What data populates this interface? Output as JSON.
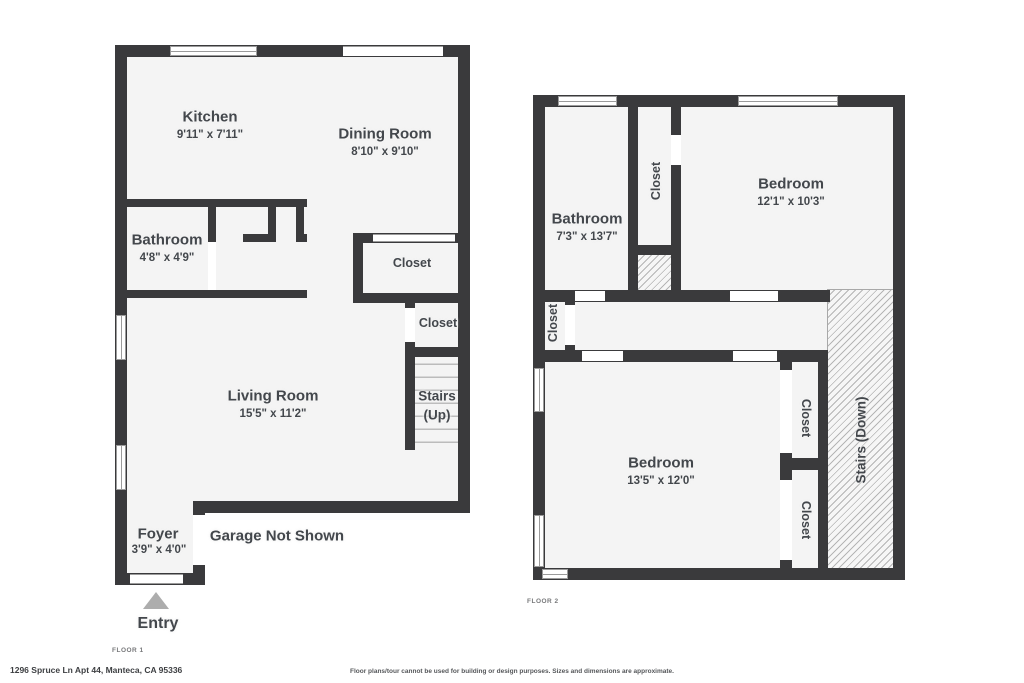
{
  "floor1": {
    "floor_label": "FLOOR 1",
    "kitchen": {
      "name": "Kitchen",
      "dims": "9'11\" x 7'11\""
    },
    "dining_room": {
      "name": "Dining Room",
      "dims": "8'10\" x 9'10\""
    },
    "bathroom": {
      "name": "Bathroom",
      "dims": "4'8\" x 4'9\""
    },
    "closet_upper": {
      "name": "Closet"
    },
    "closet_lower": {
      "name": "Closet"
    },
    "living_room": {
      "name": "Living Room",
      "dims": "15'5\" x 11'2\""
    },
    "stairs": {
      "name": "Stairs",
      "direction": "(Up)"
    },
    "foyer": {
      "name": "Foyer",
      "dims": "3'9\" x 4'0\""
    },
    "garage_note": "Garage Not Shown",
    "entry_label": "Entry"
  },
  "floor2": {
    "floor_label": "FLOOR 2",
    "bathroom": {
      "name": "Bathroom",
      "dims": "7'3\" x 13'7\""
    },
    "closet_bedroom_top": {
      "name": "Closet"
    },
    "bedroom_top": {
      "name": "Bedroom",
      "dims": "12'1\" x 10'3\""
    },
    "closet_hall": {
      "name": "Closet"
    },
    "bedroom_main": {
      "name": "Bedroom",
      "dims": "13'5\" x 12'0\""
    },
    "closet_right_upper": {
      "name": "Closet"
    },
    "closet_right_lower": {
      "name": "Closet"
    },
    "stairs_label": "Stairs (Down)"
  },
  "footer": {
    "address": "1296 Spruce Ln Apt 44, Manteca, CA 95336",
    "disclaimer": "Floor plans/tour cannot be used for building or design purposes. Sizes and dimensions are approximate."
  },
  "colors": {
    "wall": "#3a3a3c",
    "floor": "#f4f4f4",
    "text": "#43474c",
    "winline": "#9b9b9b",
    "hatchline": "#b5b5b5",
    "tread": "#bcbcbc",
    "triangle": "#adadad",
    "muted": "#77787a"
  }
}
